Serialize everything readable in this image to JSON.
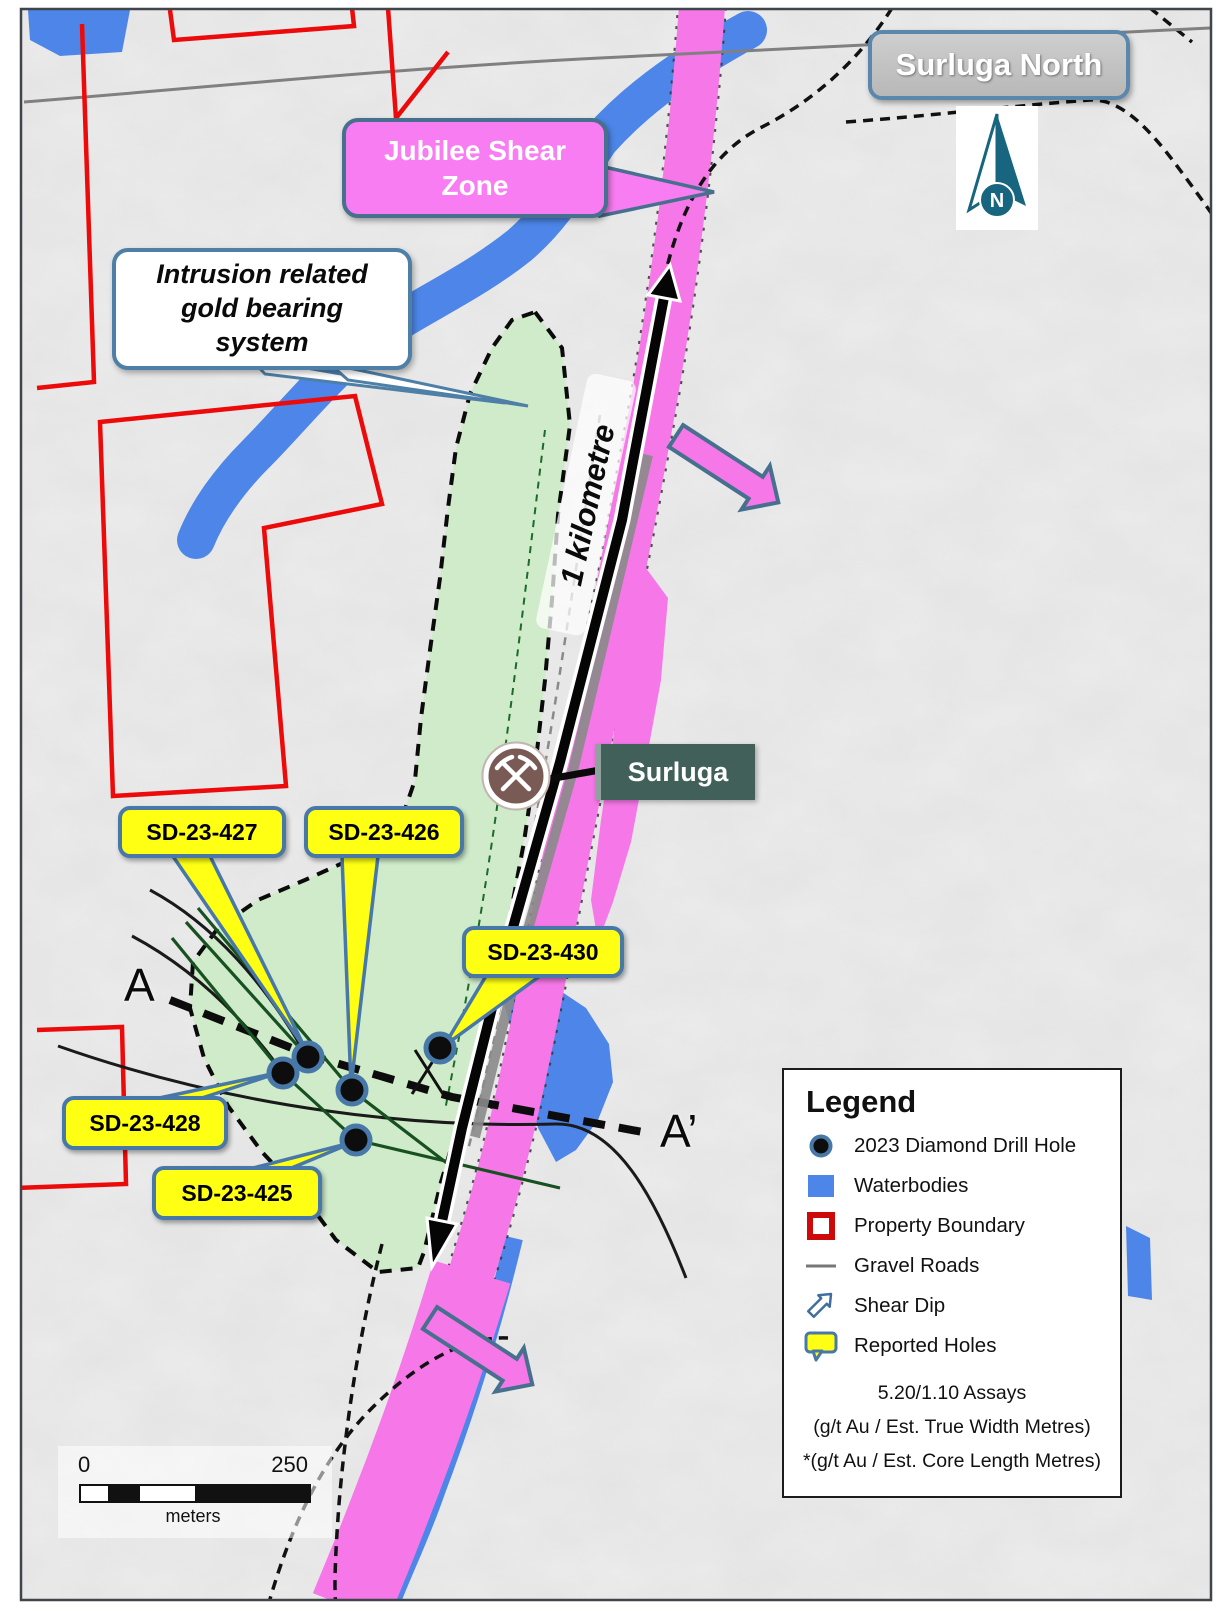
{
  "map": {
    "title": "Surluga North",
    "north_label": "N",
    "annotations": {
      "jubilee_line1": "Jubilee Shear",
      "jubilee_line2": "Zone",
      "intrusion_line1": "Intrusion related",
      "intrusion_line2": "gold bearing",
      "intrusion_line3": "system",
      "mine_label": "Surluga",
      "distance_annotation": "1 kilometre",
      "section_start": "A",
      "section_end": "A’"
    },
    "drill_hole_callouts": [
      {
        "label": "SD-23-427"
      },
      {
        "label": "SD-23-426"
      },
      {
        "label": "SD-23-430"
      },
      {
        "label": "SD-23-428"
      },
      {
        "label": "SD-23-425"
      }
    ]
  },
  "legend": {
    "title": "Legend",
    "items": [
      {
        "icon": "drill-hole-icon",
        "label": "2023 Diamond Drill Hole"
      },
      {
        "icon": "waterbody-icon",
        "label": "Waterbodies"
      },
      {
        "icon": "property-boundary-icon",
        "label": "Property Boundary"
      },
      {
        "icon": "gravel-road-icon",
        "label": "Gravel Roads"
      },
      {
        "icon": "shear-dip-icon",
        "label": "Shear Dip"
      },
      {
        "icon": "reported-holes-icon",
        "label": "Reported Holes"
      }
    ],
    "assay_note_line1": "5.20/1.10 Assays",
    "assay_note_line2": "(g/t Au / Est. True Width Metres)",
    "assay_note_line3": "*(g/t Au / Est. Core Length Metres)"
  },
  "scale_bar": {
    "min": "0",
    "max": "250",
    "unit": "meters"
  },
  "colors": {
    "shear_zone_pink": "#f678e8",
    "waterbody_blue": "#4d86e8",
    "intrusion_green": "#cdebc8",
    "property_red": "#ed0a0a",
    "callout_yellow": "#ffff14",
    "callout_border_blue": "#4878a8",
    "north_teal": "#17657f",
    "mine_label_teal": "#41605a",
    "background_gray": "#ececec"
  }
}
